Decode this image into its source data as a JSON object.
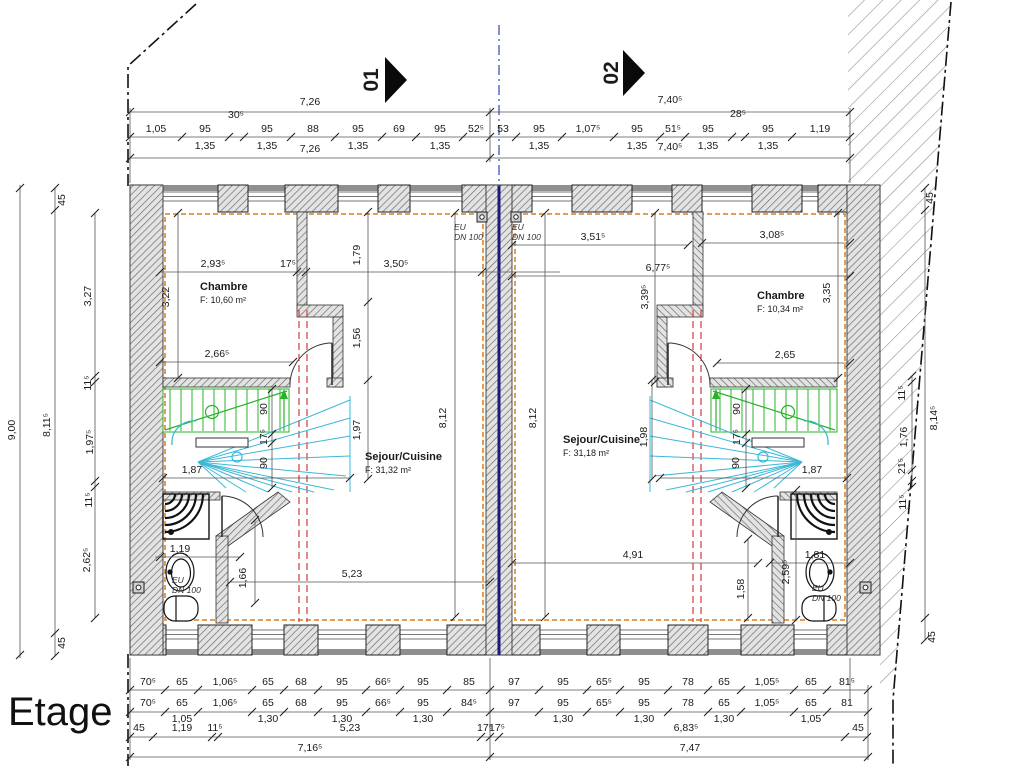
{
  "title": "Etage",
  "markers": {
    "unit1": "01",
    "unit2": "02"
  },
  "rooms": {
    "chambre1": {
      "name": "Chambre",
      "area": "F: 10,60 m²"
    },
    "sejour1": {
      "name": "Sejour/Cuisine",
      "area": "F: 31,32 m²"
    },
    "chambre2": {
      "name": "Chambre",
      "area": "F: 10,34 m²"
    },
    "sejour2": {
      "name": "Sejour/Cuisine",
      "area": "F: 31,18 m²"
    }
  },
  "plumbing": {
    "label_line1": "EU",
    "label_line2": "DN 100"
  },
  "dims": {
    "top": {
      "total_left": "7,26",
      "total_right": "7,40⁵",
      "left_chain": [
        "1,05",
        "95",
        "30⁵",
        "95",
        "88",
        "95",
        "69",
        "95",
        "52⁵"
      ],
      "left_sub": [
        "1,35",
        "1,35",
        "1,35",
        "1,35"
      ],
      "right_chain": [
        "53",
        "95",
        "1,07⁵",
        "95",
        "51⁵",
        "95",
        "28⁵",
        "95",
        "1,19"
      ],
      "right_sub": [
        "1,35",
        "1,35",
        "1,35",
        "1,35"
      ]
    },
    "left": {
      "total": "9,00",
      "inner": "8,11⁵",
      "wall_top": "45",
      "wall_bottom": "45",
      "chain": [
        "3,27",
        "11⁵",
        "1,97⁵",
        "11⁵",
        "2,62⁵"
      ]
    },
    "right": {
      "total": "8,14⁵",
      "wall_top": "45",
      "wall_bottom": "45",
      "chain": [
        "11⁵",
        "1,76",
        "21⁵",
        "11⁵"
      ]
    },
    "unit1": {
      "chambre_w": "2,93⁵",
      "wall_t": "17⁵",
      "chambre_h": "3,22",
      "chambre_door": "2,66⁵",
      "v1": "1,79",
      "sejour_top": "3,50⁵",
      "v2": "1,56",
      "v3": "1,97",
      "sejour_h": "8,12",
      "stair_run1": "90",
      "stair_mid": "17⁵",
      "stair_run2": "90",
      "stair_w": "1,87",
      "bath_w": "1,19",
      "bath_h": "1,66",
      "bottom_w": "5,23"
    },
    "unit2": {
      "top_w1": "3,51⁵",
      "top_w2": "6,77⁵",
      "v1": "3,39⁵",
      "chambre_w": "3,08⁵",
      "chambre_h": "3,35",
      "chambre_door": "2,65",
      "sejour_h": "8,12",
      "v2": "1,98",
      "stair_run1": "90",
      "stair_mid": "17⁵",
      "stair_run2": "90",
      "stair_w": "1,87",
      "bottom_w": "4,91",
      "bath_w": "1,81",
      "bath_v1": "2,59⁵",
      "bath_v2": "1,58"
    },
    "bottom": {
      "left_chain1": [
        "70⁵",
        "65",
        "1,06⁵",
        "65",
        "68",
        "95",
        "66⁵",
        "95",
        "85"
      ],
      "left_chain2": [
        "70⁵",
        "65",
        "1,06⁵",
        "65",
        "68",
        "95",
        "66⁵",
        "95",
        "84⁵"
      ],
      "left_sub": [
        "1,05",
        "1,30",
        "1,30",
        "1,30"
      ],
      "left_chain3": [
        "45",
        "1,19",
        "11⁵",
        "5,23",
        "17⁵"
      ],
      "left_total": "7,16⁵",
      "right_chain1": [
        "97",
        "95",
        "65⁵",
        "95",
        "78",
        "65",
        "1,05⁵",
        "65",
        "81⁵"
      ],
      "right_chain2": [
        "97",
        "95",
        "65⁵",
        "95",
        "78",
        "65",
        "1,05⁵",
        "65",
        "81"
      ],
      "right_sub": [
        "1,30",
        "1,30",
        "1,30",
        "1,05"
      ],
      "right_chain3": [
        "17⁵",
        "6,83⁵",
        "45"
      ],
      "right_total": "7,47"
    }
  }
}
